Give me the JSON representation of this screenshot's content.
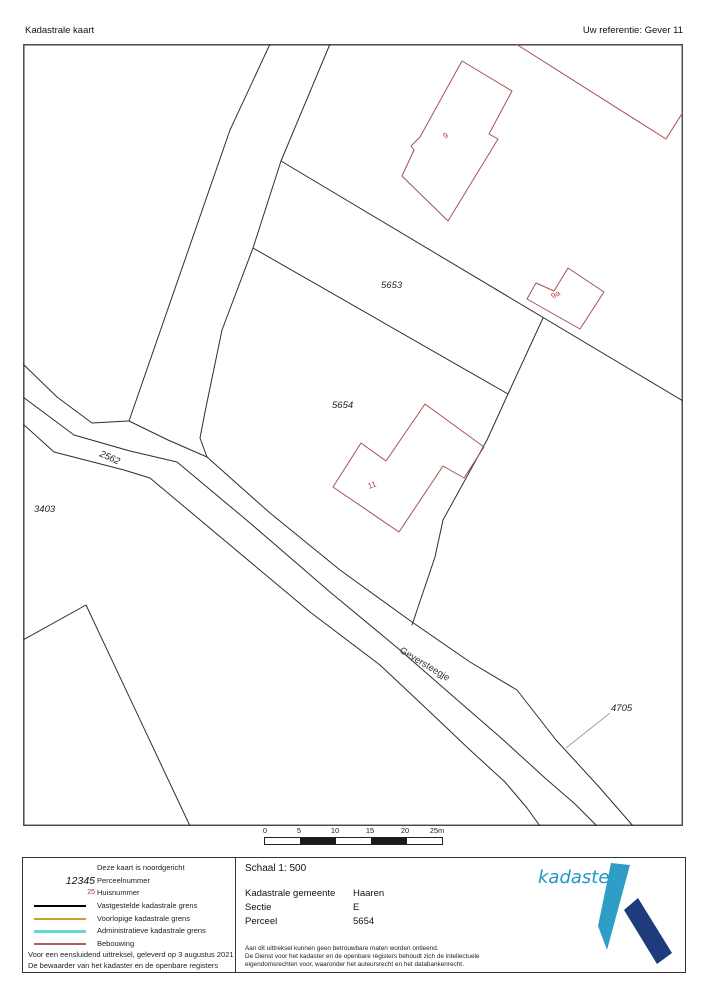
{
  "header": {
    "title": "Kadastrale kaart",
    "reference": "Uw referentie: Gever 11"
  },
  "map": {
    "labels": [
      {
        "name": "parcel-label-5653",
        "text": "5653",
        "x": 381,
        "y": 288,
        "color": "#1f1f1f",
        "italic": true,
        "rot": 0,
        "size": 9.5
      },
      {
        "name": "parcel-label-5654",
        "text": "5654",
        "x": 332,
        "y": 408,
        "color": "#1f1f1f",
        "italic": true,
        "rot": 0,
        "size": 9.5
      },
      {
        "name": "parcel-label-2562",
        "text": "2562",
        "x": 99,
        "y": 456,
        "color": "#1f1f1f",
        "italic": true,
        "rot": 24,
        "size": 9.5
      },
      {
        "name": "parcel-label-3403",
        "text": "3403",
        "x": 34,
        "y": 512,
        "color": "#1f1f1f",
        "italic": true,
        "rot": 0,
        "size": 9.5
      },
      {
        "name": "parcel-label-4705",
        "text": "4705",
        "x": 611,
        "y": 711,
        "color": "#1f1f1f",
        "italic": true,
        "rot": 0,
        "size": 9.5
      },
      {
        "name": "street-label-geversteegje",
        "text": "Geversteegje",
        "x": 399,
        "y": 652,
        "color": "#333333",
        "italic": false,
        "rot": 31,
        "size": 9.5
      },
      {
        "name": "house-number-9",
        "text": "9",
        "x": 445,
        "y": 139,
        "color": "#b23b3b",
        "italic": false,
        "rot": -30,
        "size": 8
      },
      {
        "name": "house-number-9a",
        "text": "9a",
        "x": 553,
        "y": 299,
        "color": "#b23b3b",
        "italic": false,
        "rot": -30,
        "size": 8
      },
      {
        "name": "house-number-11",
        "text": "11",
        "x": 369,
        "y": 489,
        "color": "#b23b3b",
        "italic": false,
        "rot": -20,
        "size": 8
      }
    ],
    "scale_bar": {
      "ticks": [
        "0",
        "5",
        "10",
        "15",
        "20",
        "25m"
      ]
    },
    "line_colors": {
      "parcel_boundary": "#2e2e2e",
      "building": "#a35252",
      "map_border": "#4a4a4a"
    }
  },
  "legend": {
    "items": [
      {
        "label": "Deze kaart is noordgericht"
      },
      {
        "symbol": "12345",
        "label": "Perceelnummer"
      },
      {
        "symbol": "25",
        "label": "Huisnummer"
      },
      {
        "label": "Vastgestelde kadastrale grens",
        "swatch_style": "background-color:#000000;height:2px"
      },
      {
        "label": "Voorlopige kadastrale grens",
        "swatch_style": "background-color:#c9a227;height:2.4px"
      },
      {
        "label": "Administratieve kadastrale grens",
        "swatch_style": "background-color:#63d9cf;height:2.4px"
      },
      {
        "label": "Bebouwing",
        "swatch_style": "background-color:#b25959;height:1.6px"
      }
    ],
    "footer_lines": [
      "Voor een eensluidend uittreksel, geleverd op 3 augustus 2021",
      "De bewaarder van het kadaster en de openbare registers"
    ]
  },
  "info": {
    "scale_label": "Schaal 1: 500",
    "rows": [
      {
        "label": "Kadastrale gemeente",
        "value": "Haaren"
      },
      {
        "label": "Sectie",
        "value": "E"
      },
      {
        "label": "Perceel",
        "value": "5654"
      }
    ],
    "disclaimer": [
      "Aan dit uittreksel kunnen geen betrouwbare maten worden ontleend.",
      "De Dienst voor het kadaster en de openbare registers behoudt zich de intellectuele",
      "eigendomsrechten voor, waaronder het auteursrecht en het databankenrecht."
    ]
  },
  "logo": {
    "text": "kadaster",
    "text_color": "#1e96c8",
    "shape_light": "#2e9ec7",
    "shape_dark": "#1e3c7b"
  }
}
